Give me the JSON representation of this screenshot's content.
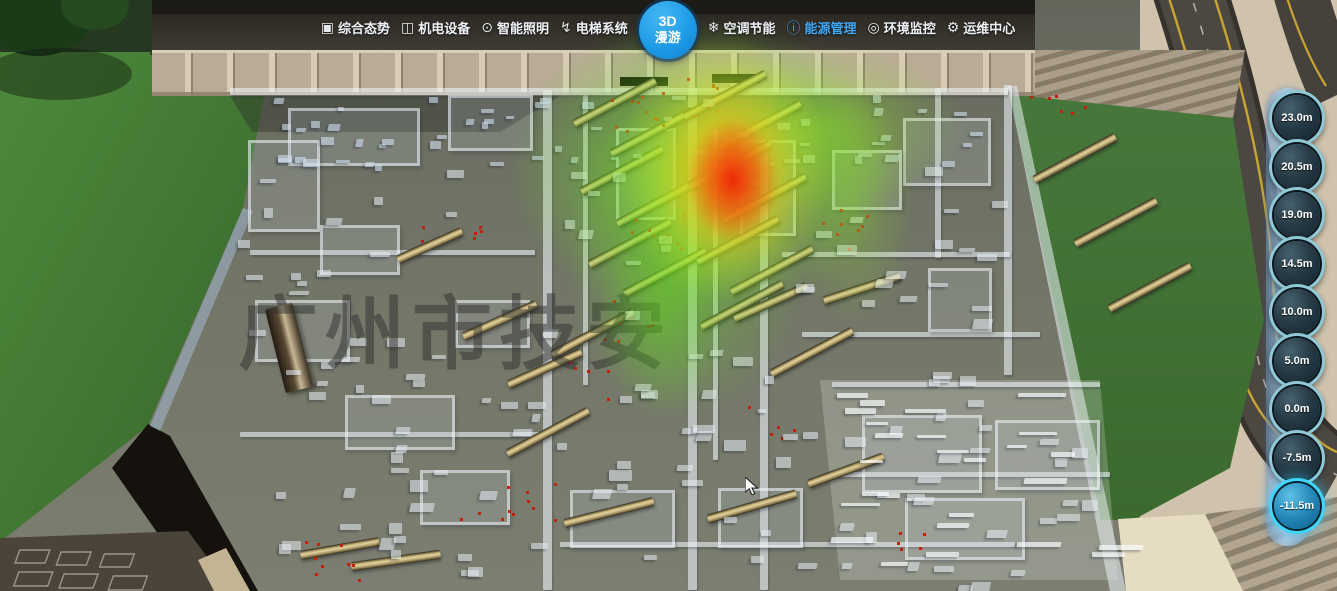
{
  "nav": {
    "items": [
      {
        "label": "综合态势",
        "icon": "▣"
      },
      {
        "label": "机电设备",
        "icon": "◫"
      },
      {
        "label": "智能照明",
        "icon": "⊙"
      },
      {
        "label": "电梯系统",
        "icon": "↯"
      },
      {
        "label": "空调节能",
        "icon": "❄"
      },
      {
        "label": "能源管理",
        "icon": "ⓘ",
        "active": true
      },
      {
        "label": "环境监控",
        "icon": "◎"
      },
      {
        "label": "运维中心",
        "icon": "⚙"
      }
    ],
    "roam_button": {
      "line1": "3D",
      "line2": "漫游"
    },
    "active_color": "#41a8f7"
  },
  "floor_selector": {
    "levels": [
      {
        "label": "23.0m"
      },
      {
        "label": "20.5m"
      },
      {
        "label": "19.0m"
      },
      {
        "label": "14.5m"
      },
      {
        "label": "10.0m"
      },
      {
        "label": "5.0m"
      },
      {
        "label": "0.0m"
      },
      {
        "label": "-7.5m"
      },
      {
        "label": "-11.5m",
        "active": true
      }
    ],
    "active_ring_color": "#3fd6ff"
  },
  "watermark": "广州市技安",
  "heatmap": {
    "high_color": "#f01c08",
    "mid_color": "#f8ee26",
    "low_color": "#70e81c"
  }
}
